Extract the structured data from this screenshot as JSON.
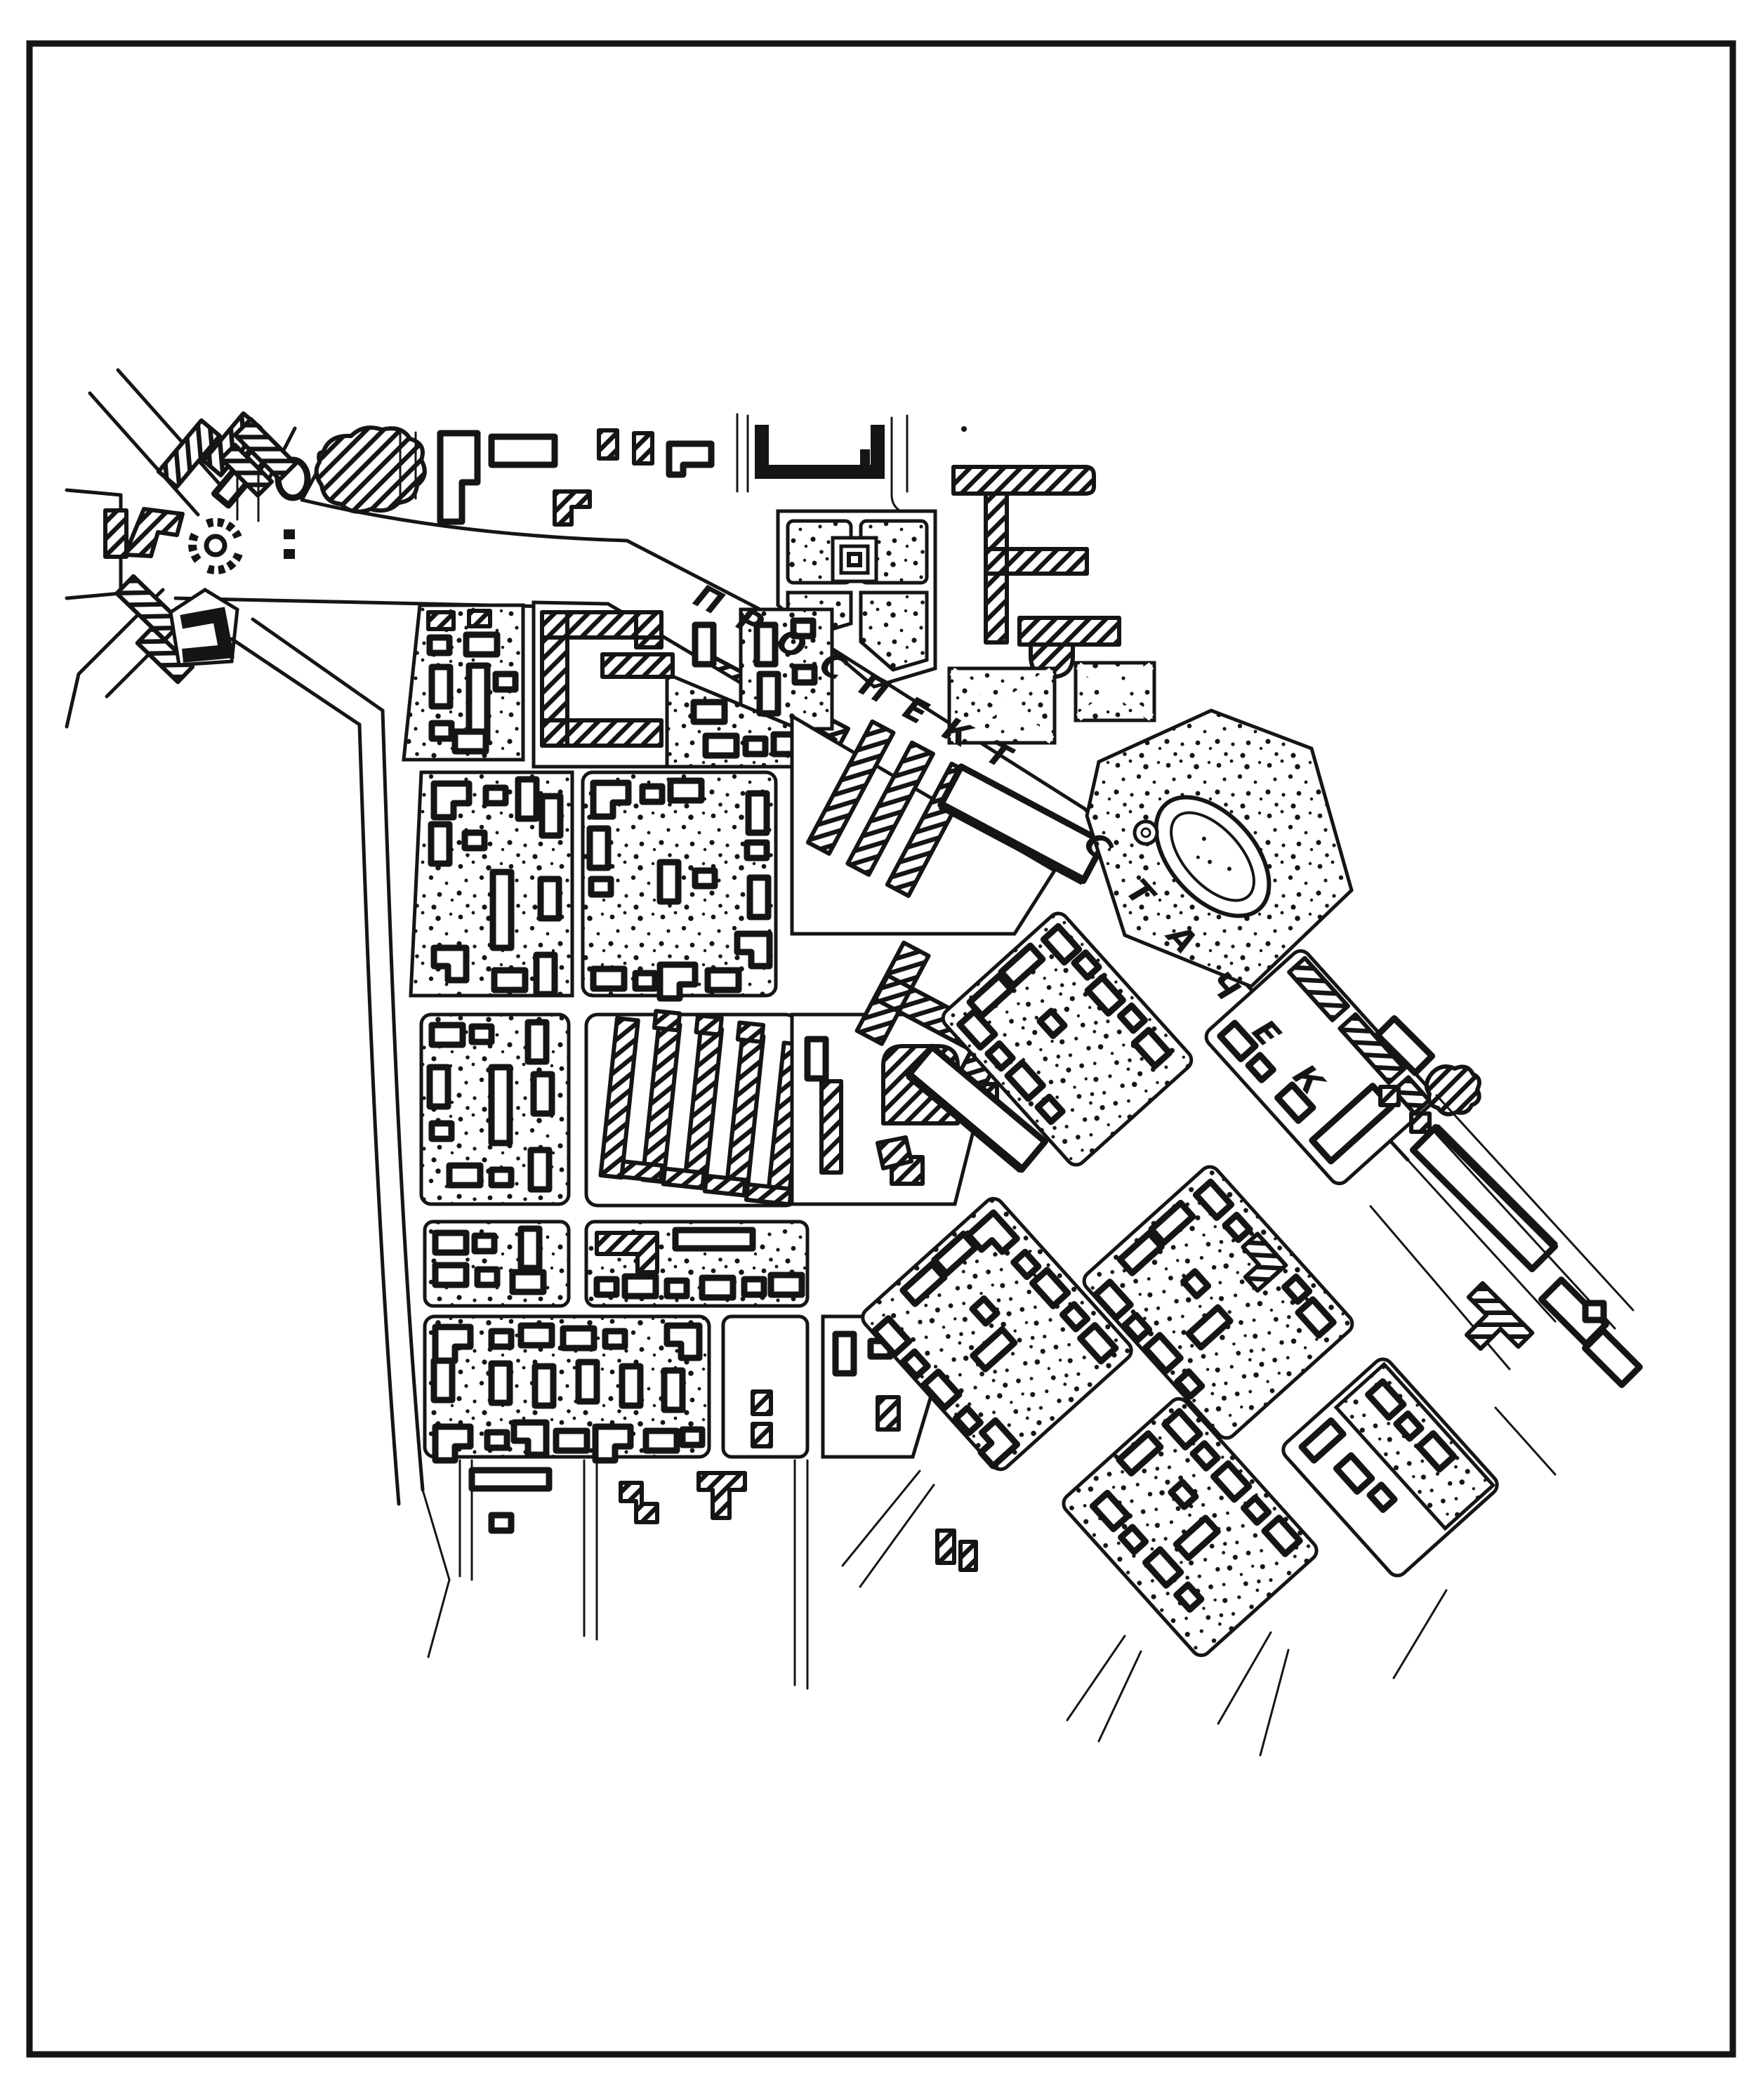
{
  "map": {
    "kind": "hand-drawn urban district plan, black ink on white",
    "street_labels": {
      "prospekt": {
        "text": "ПРОСПЕКТ",
        "letters": [
          "П",
          "Р",
          "О",
          "С",
          "П",
          "Е",
          "К",
          "Т"
        ],
        "angle_deg": 28
      },
      "stachek": {
        "text": "СТАЧЕК",
        "letters": [
          "С",
          "Т",
          "А",
          "Ч",
          "Е",
          "К"
        ],
        "angle_deg": 48
      }
    },
    "features": [
      "border-frame",
      "roundabout-plaza",
      "garden-square-with-monument",
      "comb-building",
      "u-building",
      "pond-garden",
      "parallel-slab-row",
      "stippled-residential-blocks",
      "diagonal-block-grid",
      "tree-mass",
      "factory-building",
      "school-building",
      "trailing-streets"
    ],
    "colors": {
      "ink": "#151515",
      "paper": "#ffffff"
    }
  }
}
